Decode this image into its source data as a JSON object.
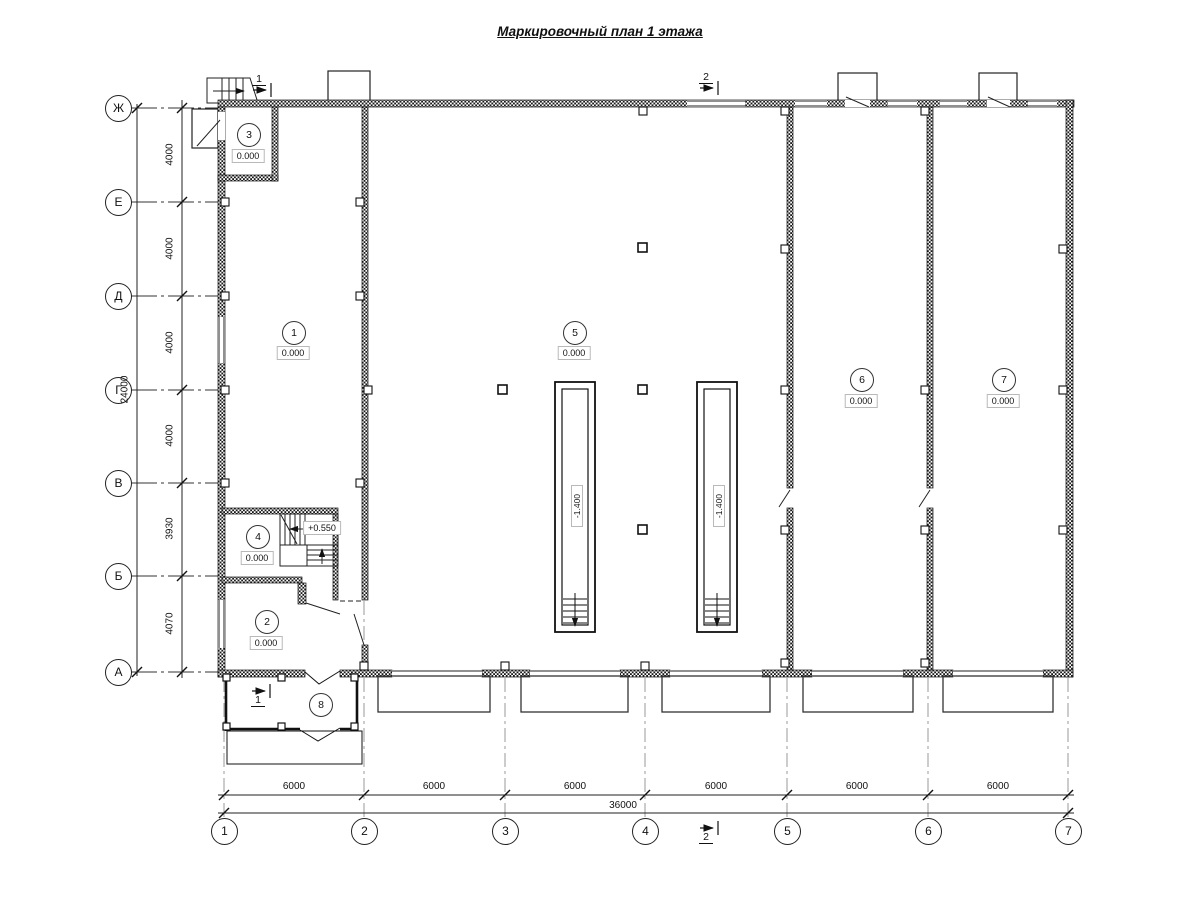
{
  "title": "Маркировочный план 1 этажа",
  "axes": {
    "rows": [
      {
        "label": "Ж"
      },
      {
        "label": "Е"
      },
      {
        "label": "Д"
      },
      {
        "label": "Г"
      },
      {
        "label": "В"
      },
      {
        "label": "Б"
      },
      {
        "label": "А"
      }
    ],
    "cols": [
      {
        "label": "1"
      },
      {
        "label": "2"
      },
      {
        "label": "3"
      },
      {
        "label": "4"
      },
      {
        "label": "5"
      },
      {
        "label": "6"
      },
      {
        "label": "7"
      }
    ]
  },
  "dims": {
    "row_segments": [
      "4000",
      "4000",
      "4000",
      "4000",
      "3930",
      "4070"
    ],
    "row_total": "24000",
    "col_segments": [
      "6000",
      "6000",
      "6000",
      "6000",
      "6000",
      "6000"
    ],
    "col_total": "36000"
  },
  "rooms": [
    {
      "number": "1",
      "elevation": "0.000"
    },
    {
      "number": "2",
      "elevation": "0.000"
    },
    {
      "number": "3",
      "elevation": "0.000"
    },
    {
      "number": "4",
      "elevation": "0.000"
    },
    {
      "number": "5",
      "elevation": "0.000"
    },
    {
      "number": "6",
      "elevation": "0.000"
    },
    {
      "number": "7",
      "elevation": "0.000"
    },
    {
      "number": "8"
    }
  ],
  "annotations": {
    "pit_elevation": "-1.400",
    "stair_landing_elevation": "+0.550"
  },
  "section_markers": [
    {
      "label": "1"
    },
    {
      "label": "2"
    }
  ]
}
